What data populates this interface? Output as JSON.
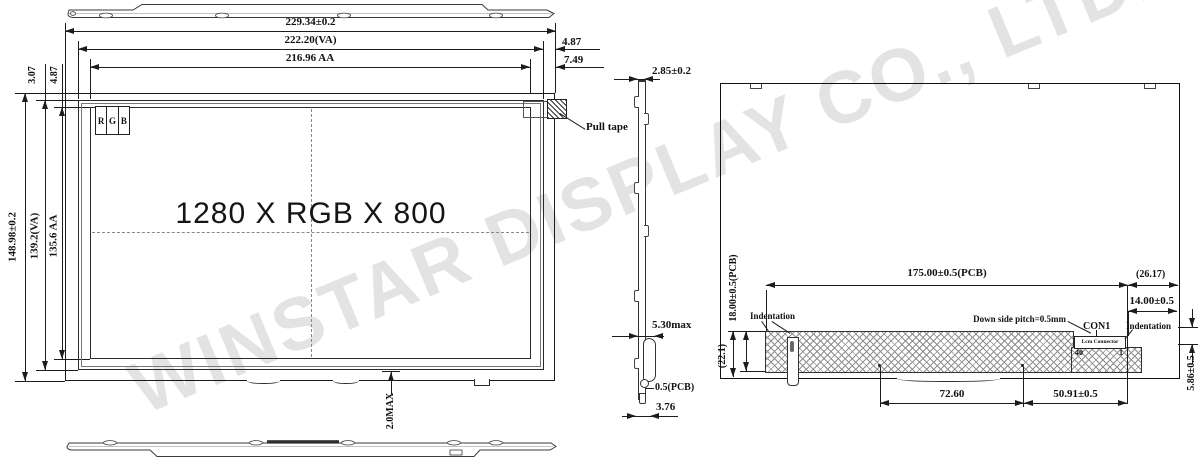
{
  "watermark": "WINSTAR DISPLAY CO., LTD.",
  "front_view": {
    "resolution": "1280 X RGB X 800",
    "rgb": {
      "r": "R",
      "g": "G",
      "b": "B"
    },
    "pull_tape_label": "Pull tape",
    "dim_width_outline": "229.34±0.2",
    "dim_width_va": "222.20(VA)",
    "dim_width_aa": "216.96 AA",
    "dim_right_va_margin": "4.87",
    "dim_right_aa_margin": "7.49",
    "dim_left_margin_va": "3.07",
    "dim_left_margin_aa": "4.87",
    "dim_height_outline": "148.98±0.2",
    "dim_height_va": "139.2(VA)",
    "dim_height_aa": "135.6 AA",
    "dim_bottom_protrusion": "2.0MAX"
  },
  "side_view": {
    "dim_thickness": "2.85±0.2",
    "dim_max_thickness": "5.30max",
    "dim_pcb_thickness": "0.5(PCB)",
    "dim_bottom_width": "3.76"
  },
  "back_view": {
    "dim_pcb_width": "175.00±0.5(PCB)",
    "dim_right_ref": "(26.17)",
    "dim_connector_offset": "14.00±0.5",
    "dim_pcb_height": "18.00±0.5(PCB)",
    "dim_left_ref": "(22.1)",
    "dim_hole_span": "72.60",
    "dim_connector_span": "50.91±0.5",
    "dim_connector_height": "5.86±0.5",
    "label_indentation_left": "Indentation",
    "label_indentation_right": "Indentation",
    "label_down_side_pitch": "Down side pitch=0.5mm",
    "label_con1": "CON1",
    "label_lcm_connector": "Lcm Connector",
    "pin_first": "40",
    "pin_last": "1"
  }
}
